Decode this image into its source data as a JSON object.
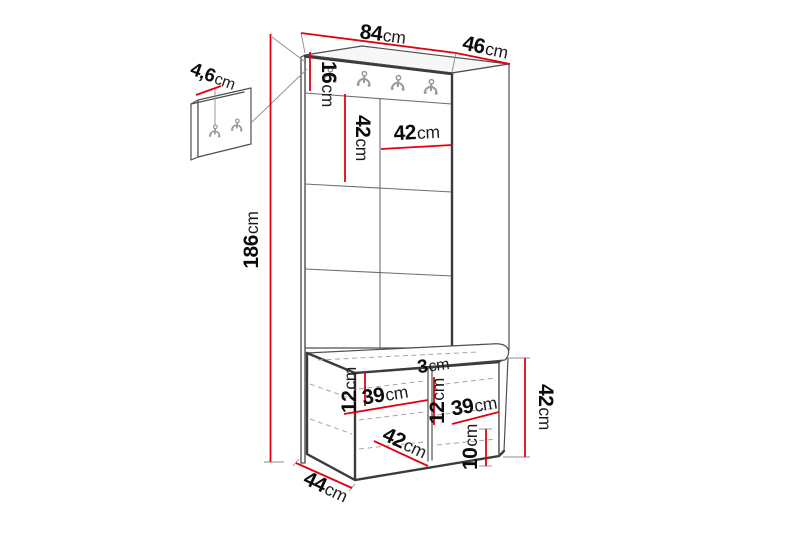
{
  "diagram": {
    "type": "furniture-dimension-drawing",
    "subject": "hallway unit with coat hook panel and shoe bench",
    "dimension_line_color": "#e30010",
    "icons": {
      "coat_hook": "double-coat-hook",
      "rail_hook_count": 4,
      "wall_panel_hook_count": 2
    }
  },
  "dims": {
    "total_width": {
      "value": "84",
      "unit": "cm"
    },
    "total_depth": {
      "value": "46",
      "unit": "cm"
    },
    "total_height": {
      "value": "186",
      "unit": "cm"
    },
    "hook_rail_height": {
      "value": "16",
      "unit": "cm"
    },
    "panel_tile_height": {
      "value": "42",
      "unit": "cm"
    },
    "panel_tile_width": {
      "value": "42",
      "unit": "cm"
    },
    "hook_panel_depth": {
      "value": "4,6",
      "unit": "cm"
    },
    "bench_inset_left": {
      "value": "12",
      "unit": "cm"
    },
    "bench_compartment_left": {
      "value": "39",
      "unit": "cm"
    },
    "divider_thickness": {
      "value": "3",
      "unit": "cm"
    },
    "bench_inset_mid": {
      "value": "12",
      "unit": "cm"
    },
    "bench_compartment_right": {
      "value": "39",
      "unit": "cm"
    },
    "bench_bottom_height": {
      "value": "10",
      "unit": "cm"
    },
    "bench_inner_depth": {
      "value": "42",
      "unit": "cm"
    },
    "bench_height": {
      "value": "42",
      "unit": "cm"
    },
    "bench_depth": {
      "value": "44",
      "unit": "cm"
    }
  }
}
